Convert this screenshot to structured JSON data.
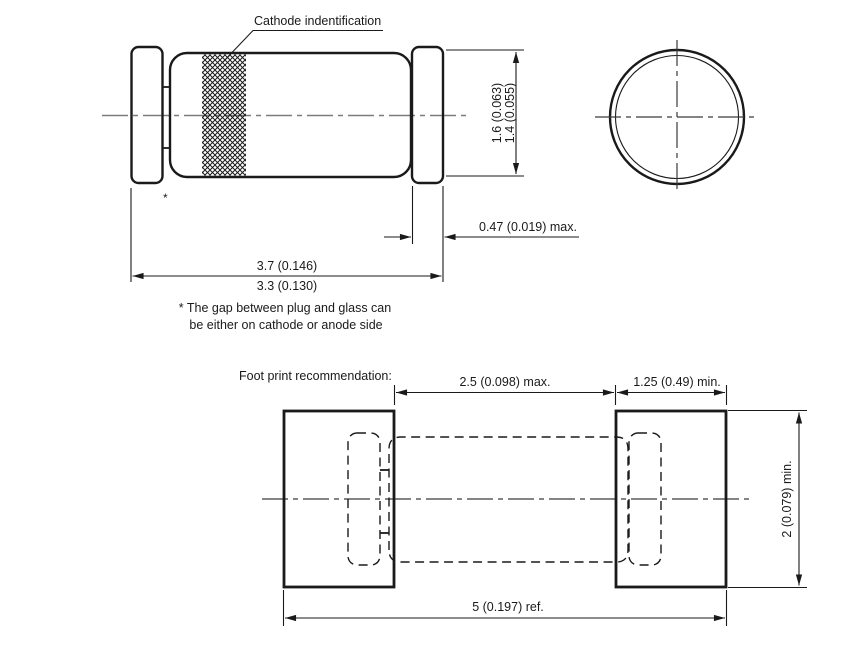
{
  "colors": {
    "line": "#1a1a1a",
    "centerline": "#7c7c7c",
    "centerline_dark": "#3a3a3a",
    "background": "#ffffff"
  },
  "side_view": {
    "cathode_label": "Cathode indentification",
    "gap_marker": "*",
    "dims": {
      "diameter_max": "1.6 (0.063)",
      "diameter_min": "1.4 (0.055)",
      "cap_length": "0.47 (0.019) max.",
      "body_length_max": "3.7 (0.146)",
      "body_length_min": "3.3 (0.130)"
    },
    "note_line1": "* The gap between plug and glass can",
    "note_line2": "be either on cathode or anode side"
  },
  "footprint": {
    "title": "Foot print recommendation:",
    "dims": {
      "pad_gap": "2.5 (0.098) max.",
      "pad_width": "1.25 (0.49) min.",
      "pad_height": "2 (0.079) min.",
      "overall": "5 (0.197) ref."
    }
  }
}
